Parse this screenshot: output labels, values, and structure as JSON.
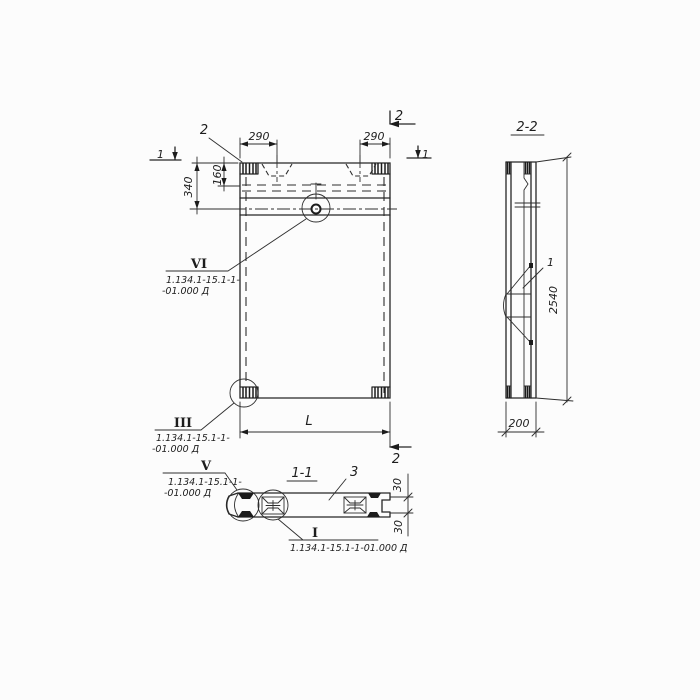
{
  "colors": {
    "ink": "#262626",
    "paper": "#fcfcfc"
  },
  "front_view": {
    "callout_2": "2",
    "section1_marker_left": "1",
    "section1_marker_right": "1",
    "section2_marker_top": "2",
    "section2_marker_bottom": "2",
    "dim_290_left": "290",
    "dim_290_right": "290",
    "dim_160": "160",
    "dim_340": "340",
    "dim_length": "L",
    "detail_vi": {
      "mark": "VI",
      "ref_line1": "1.134.1-15.1-1-",
      "ref_line2": "-01.000 Д"
    },
    "detail_iii": {
      "mark": "III",
      "ref_line1": "1.134.1-15.1-1-",
      "ref_line2": "-01.000 Д"
    }
  },
  "section_2_2": {
    "label": "2-2",
    "callout_1": "1",
    "dim_height": "2540",
    "dim_width": "200"
  },
  "section_1_1": {
    "label": "1-1",
    "callout_3": "3",
    "dim_30_top": "30",
    "dim_30_bottom": "30",
    "detail_v": {
      "mark": "V",
      "ref_line1": "1.134.1-15.1-1-",
      "ref_line2": "-01.000 Д"
    },
    "detail_i": {
      "mark": "I",
      "ref": "1.134.1-15.1-1-01.000 Д"
    }
  }
}
